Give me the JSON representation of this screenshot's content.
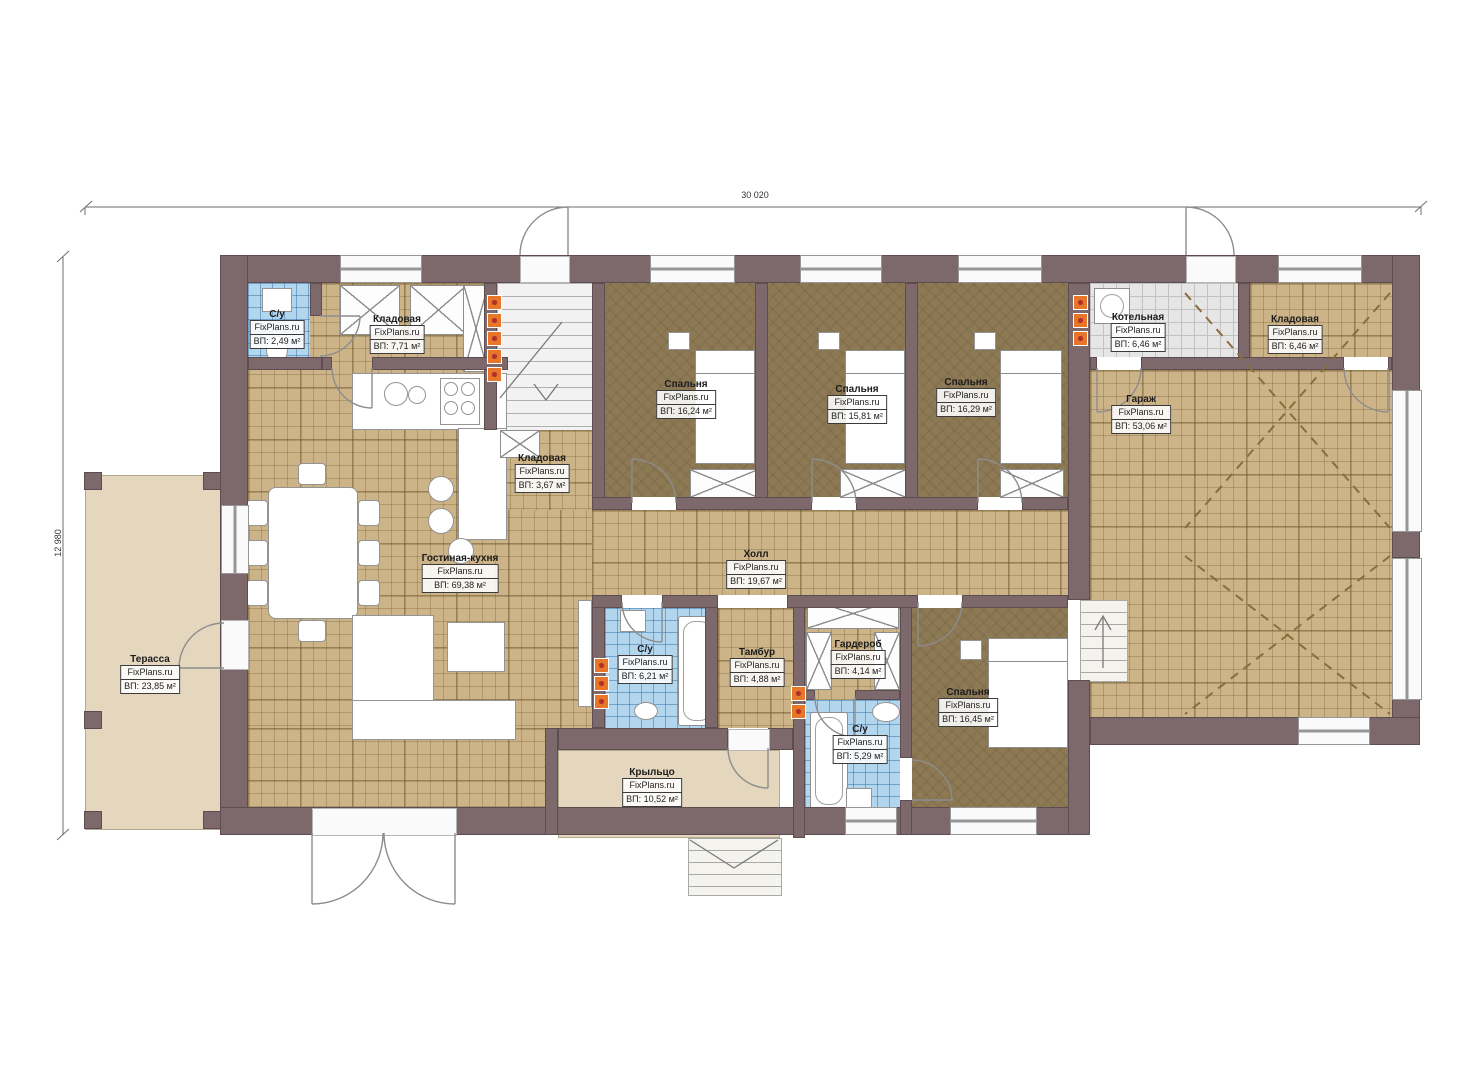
{
  "meta": {
    "watermark": "FixPlans.ru",
    "plan_type": "floor-plan"
  },
  "dimensions": {
    "width_label": "30 020",
    "height_label": "12 980"
  },
  "rooms": [
    {
      "name": "С/у",
      "area": "ВП: 2,49 м²"
    },
    {
      "name": "Кладовая",
      "area": "ВП: 7,71 м²"
    },
    {
      "name": "Спальня",
      "area": "ВП: 16,24 м²"
    },
    {
      "name": "Спальня",
      "area": "ВП: 15,81 м²"
    },
    {
      "name": "Спальня",
      "area": "ВП: 16,29 м²"
    },
    {
      "name": "Котельная",
      "area": "ВП: 6,46 м²"
    },
    {
      "name": "Кладовая",
      "area": "ВП: 6,46 м²"
    },
    {
      "name": "Гараж",
      "area": "ВП: 53,06 м²"
    },
    {
      "name": "Кладовая",
      "area": "ВП: 3,67 м²"
    },
    {
      "name": "Гостиная-кухня",
      "area": "ВП: 69,38 м²"
    },
    {
      "name": "Холл",
      "area": "ВП: 19,67 м²"
    },
    {
      "name": "Терасса",
      "area": "ВП: 23,85 м²"
    },
    {
      "name": "С/у",
      "area": "ВП: 6,21 м²"
    },
    {
      "name": "Тамбур",
      "area": "ВП: 4,88 м²"
    },
    {
      "name": "Гардероб",
      "area": "ВП: 4,14 м²"
    },
    {
      "name": "С/у",
      "area": "ВП: 5,29 м²"
    },
    {
      "name": "Спальня",
      "area": "ВП: 16,45 м²"
    },
    {
      "name": "Крыльцо",
      "area": "ВП: 10,52 м²"
    }
  ],
  "colors": {
    "wall": "#7d696c",
    "floor_tile_tan": "#cdb488",
    "floor_bedroom_brown": "#8d7954",
    "floor_bath_blue": "#b3d6ef",
    "floor_boiler_gray": "#e6e6e6",
    "terrace_beige": "#e4d7be",
    "vent_orange": "#e8762a"
  }
}
